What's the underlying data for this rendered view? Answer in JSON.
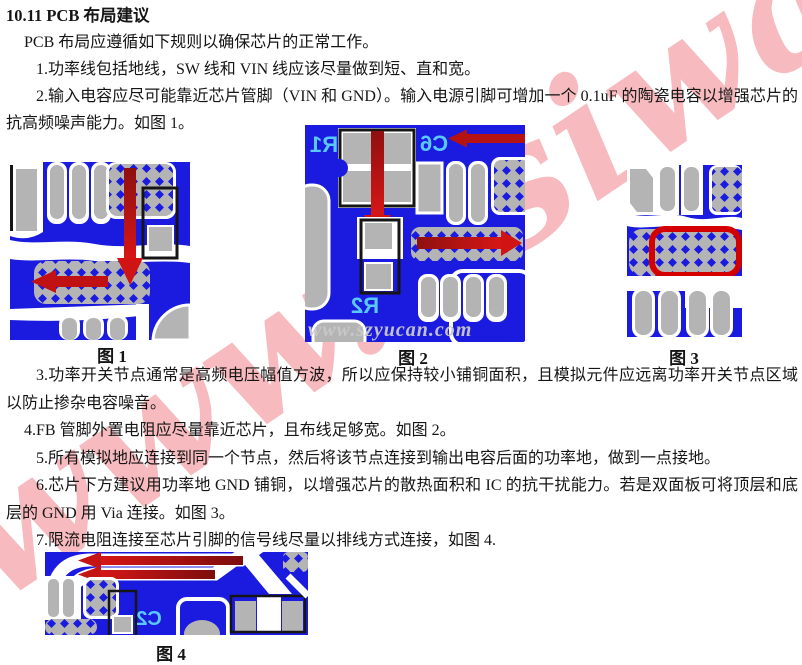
{
  "doc": {
    "heading": "10.11 PCB 布局建议",
    "intro": "PCB 布局应遵循如下规则以确保芯片的正常工作。",
    "rules": [
      "1.功率线包括地线，SW 线和 VIN 线应该尽量做到短、直和宽。",
      "2.输入电容应尽可能靠近芯片管脚（VIN 和 GND）。输入电源引脚可增加一个 0.1uF 的陶瓷电容以增强芯片的抗高频噪声能力。如图 1。",
      "3.功率开关节点通常是高频电压幅值方波，所以应保持较小铺铜面积，且模拟元件应远离功率开关节点区域以防止掺杂电容噪音。",
      "4.FB 管脚外置电阻应尽量靠近芯片，且布线足够宽。如图 2。",
      "5.所有模拟地应连接到同一个节点，然后将该节点连接到输出电容后面的功率地，做到一点接地。",
      "6.芯片下方建议用功率地 GND 铺铜，以增强芯片的散热面积和 IC 的抗干扰能力。若是双面板可将顶层和底层的 GND 用 Via 连接。如图 3。",
      "7.限流电阻连接至芯片引脚的信号线尽量以排线方式连接，如图 4."
    ]
  },
  "figures": {
    "fig1": {
      "caption": "图 1"
    },
    "fig2": {
      "caption": "图 2",
      "silkscreen": {
        "r1": "R1",
        "c6": "C6",
        "r2": "R2"
      },
      "watermark": "www.szyucan.com"
    },
    "fig3": {
      "caption": "图 3"
    },
    "fig4": {
      "caption": "图 4",
      "silkscreen": {
        "c2": "C2"
      }
    }
  },
  "watermarks": {
    "page": "www.nsiway.com"
  },
  "colors": {
    "pcb_blue": "#1b1be0",
    "pad_gray": "#b4b4b4",
    "silkscreen_cyan": "#5ac8ff",
    "arrow_red": "#c41414",
    "arrow_red_dark": "#8f1010",
    "highlight_red": "#d40000",
    "outline_black": "#151515",
    "page_watermark_pink": "#f6a9ae",
    "figure_watermark_gray": "#c9c9c9"
  }
}
